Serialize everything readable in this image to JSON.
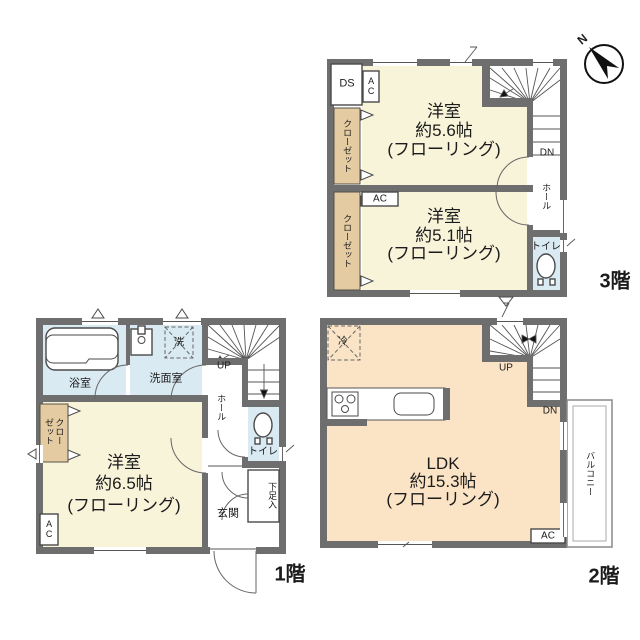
{
  "palette": {
    "wall": "#6e6e6e",
    "cream": "#f8f4da",
    "peach": "#fbe4c6",
    "tan": "#e5cba1",
    "blue": "#d9eaf2"
  },
  "compass": {
    "north": "N"
  },
  "floor3": {
    "label": "3階",
    "ds": "DS",
    "ac_upper": "AC",
    "closet_upper": "クローゼット",
    "closet_lower": "クローゼット",
    "bedroom_a": {
      "name": "洋室",
      "size": "約5.6帖",
      "finish": "(フローリング)"
    },
    "bedroom_b": {
      "name": "洋室",
      "size": "約5.1帖",
      "finish": "(フローリング)"
    },
    "ac_lower": "AC",
    "dn": "DN",
    "hall": "ホール",
    "toilet": "トイレ"
  },
  "floor1": {
    "label": "1階",
    "bath": "浴室",
    "washroom": "洗面室",
    "laundry": "洗",
    "up": "UP",
    "hall": "ホール",
    "toilet": "トイレ",
    "closet": "クローゼット",
    "bedroom": {
      "name": "洋室",
      "size": "約6.5帖",
      "finish": "(フローリング)"
    },
    "ac": "AC",
    "entrance": "玄関",
    "shoe_cabinet": "下足入"
  },
  "floor2": {
    "label": "2階",
    "refrigerator": "冷",
    "up": "UP",
    "dn": "DN",
    "ldk": {
      "name": "LDK",
      "size": "約15.3帖",
      "finish": "(フローリング)"
    },
    "balcony": "バルコニー",
    "ac": "AC"
  }
}
